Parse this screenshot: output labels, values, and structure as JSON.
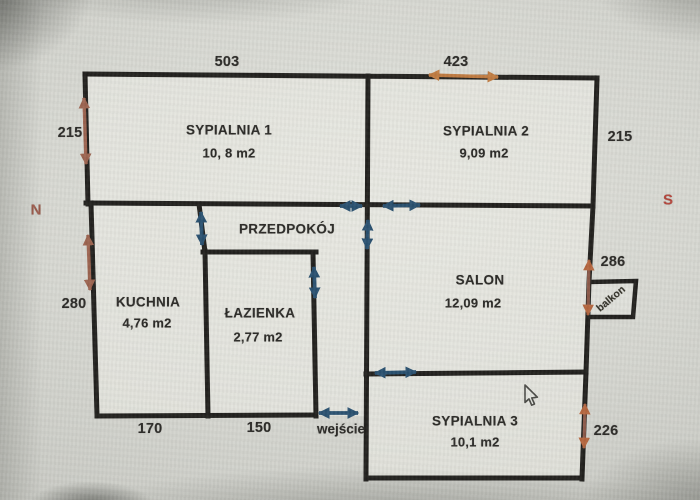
{
  "compass": {
    "north": "N",
    "south": "S"
  },
  "rooms": [
    {
      "name": "SYPIALNIA 1",
      "area": "10, 8 m2"
    },
    {
      "name": "SYPIALNIA 2",
      "area": "9,09 m2"
    },
    {
      "name": "PRZEDPOKÓJ",
      "area": ""
    },
    {
      "name": "KUCHNIA",
      "area": "4,76 m2"
    },
    {
      "name": "ŁAZIENKA",
      "area": "2,77 m2"
    },
    {
      "name": "SALON",
      "area": "12,09 m2"
    },
    {
      "name": "SYPIALNIA 3",
      "area": "10,1 m2"
    },
    {
      "name": "balkon",
      "area": ""
    }
  ],
  "dimensions": {
    "top_left_wall": "503",
    "top_right_wall": "423",
    "left_upper": "215",
    "right_upper": "215",
    "left_lower": "280",
    "balcony_side": "286",
    "right_lower": "226",
    "kitchen_bottom": "170",
    "bathroom_bottom": "150"
  },
  "labels": {
    "entrance": "wejście"
  },
  "colors": {
    "wall": "#22211e",
    "door_arrow": "#2a5170",
    "dimension_arrow_left": "#9c6450",
    "dimension_arrow_top": "#c07c42",
    "dimension_arrow_right": "#ad5f3e",
    "north_label": "#9c5a4b",
    "south_label": "#b5463c",
    "paper": "#e8e8e2"
  }
}
